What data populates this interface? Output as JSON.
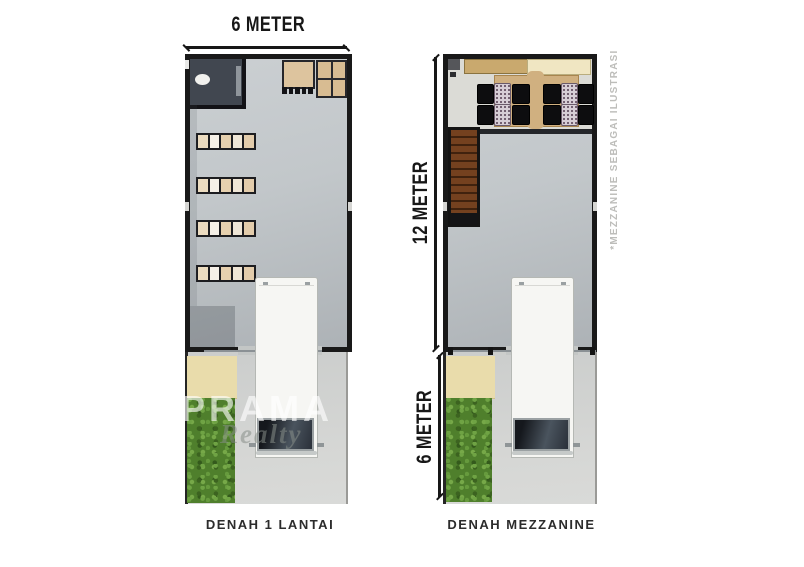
{
  "page": {
    "background": "#ffffff",
    "description": "Two floor plans of a narrow shop-house: ground floor and mezzanine, with dimension lines and carport"
  },
  "dimensions": {
    "left_top": "6 METER",
    "right_height": "12 METER",
    "right_yard": "6 METER"
  },
  "captions": {
    "left_plan": "DENAH 1 LANTAI",
    "right_plan": "DENAH MEZZANINE"
  },
  "watermark": {
    "brand": "PRAMA",
    "subbrand": "Realty"
  },
  "annotations": {
    "mezzanine_note": "*MEZZANINE SEBAGAI ILUSTRASI"
  },
  "plans": {
    "left": {
      "features": [
        "toilet",
        "desk-with-stools",
        "grid-table",
        "storage-rack-rows-x4",
        "garage-opening",
        "white-van",
        "terrace",
        "garden",
        "driveway"
      ]
    },
    "right": {
      "features": [
        "kitchen-counter",
        "dining-table-with-chairs",
        "staircase",
        "mezzanine-edge",
        "void-to-below",
        "white-van",
        "terrace",
        "garden",
        "driveway"
      ]
    }
  },
  "colors": {
    "wall": "#191919",
    "floor": "#c2c7ca",
    "mezzanine_floor": "#dbdbd6",
    "driveway": "#d2d3d1",
    "terrace": "#e9dcab",
    "grass": "#4f7f2c",
    "stairs_wood": "#74411f",
    "table_wood": "#d0b080",
    "counter_tan": "#c9a96e",
    "counter_cream": "#f0e6c2",
    "chair_black": "#0d0d0f",
    "chair_patterned": "#d6cdd5",
    "van_body": "#f6f6f3",
    "windshield": "#2a3039",
    "dimension_text": "#171717",
    "caption_text": "#2c2c2c",
    "note_text": "#bdbdba",
    "watermark_white": "rgba(255,255,255,0.62)"
  }
}
